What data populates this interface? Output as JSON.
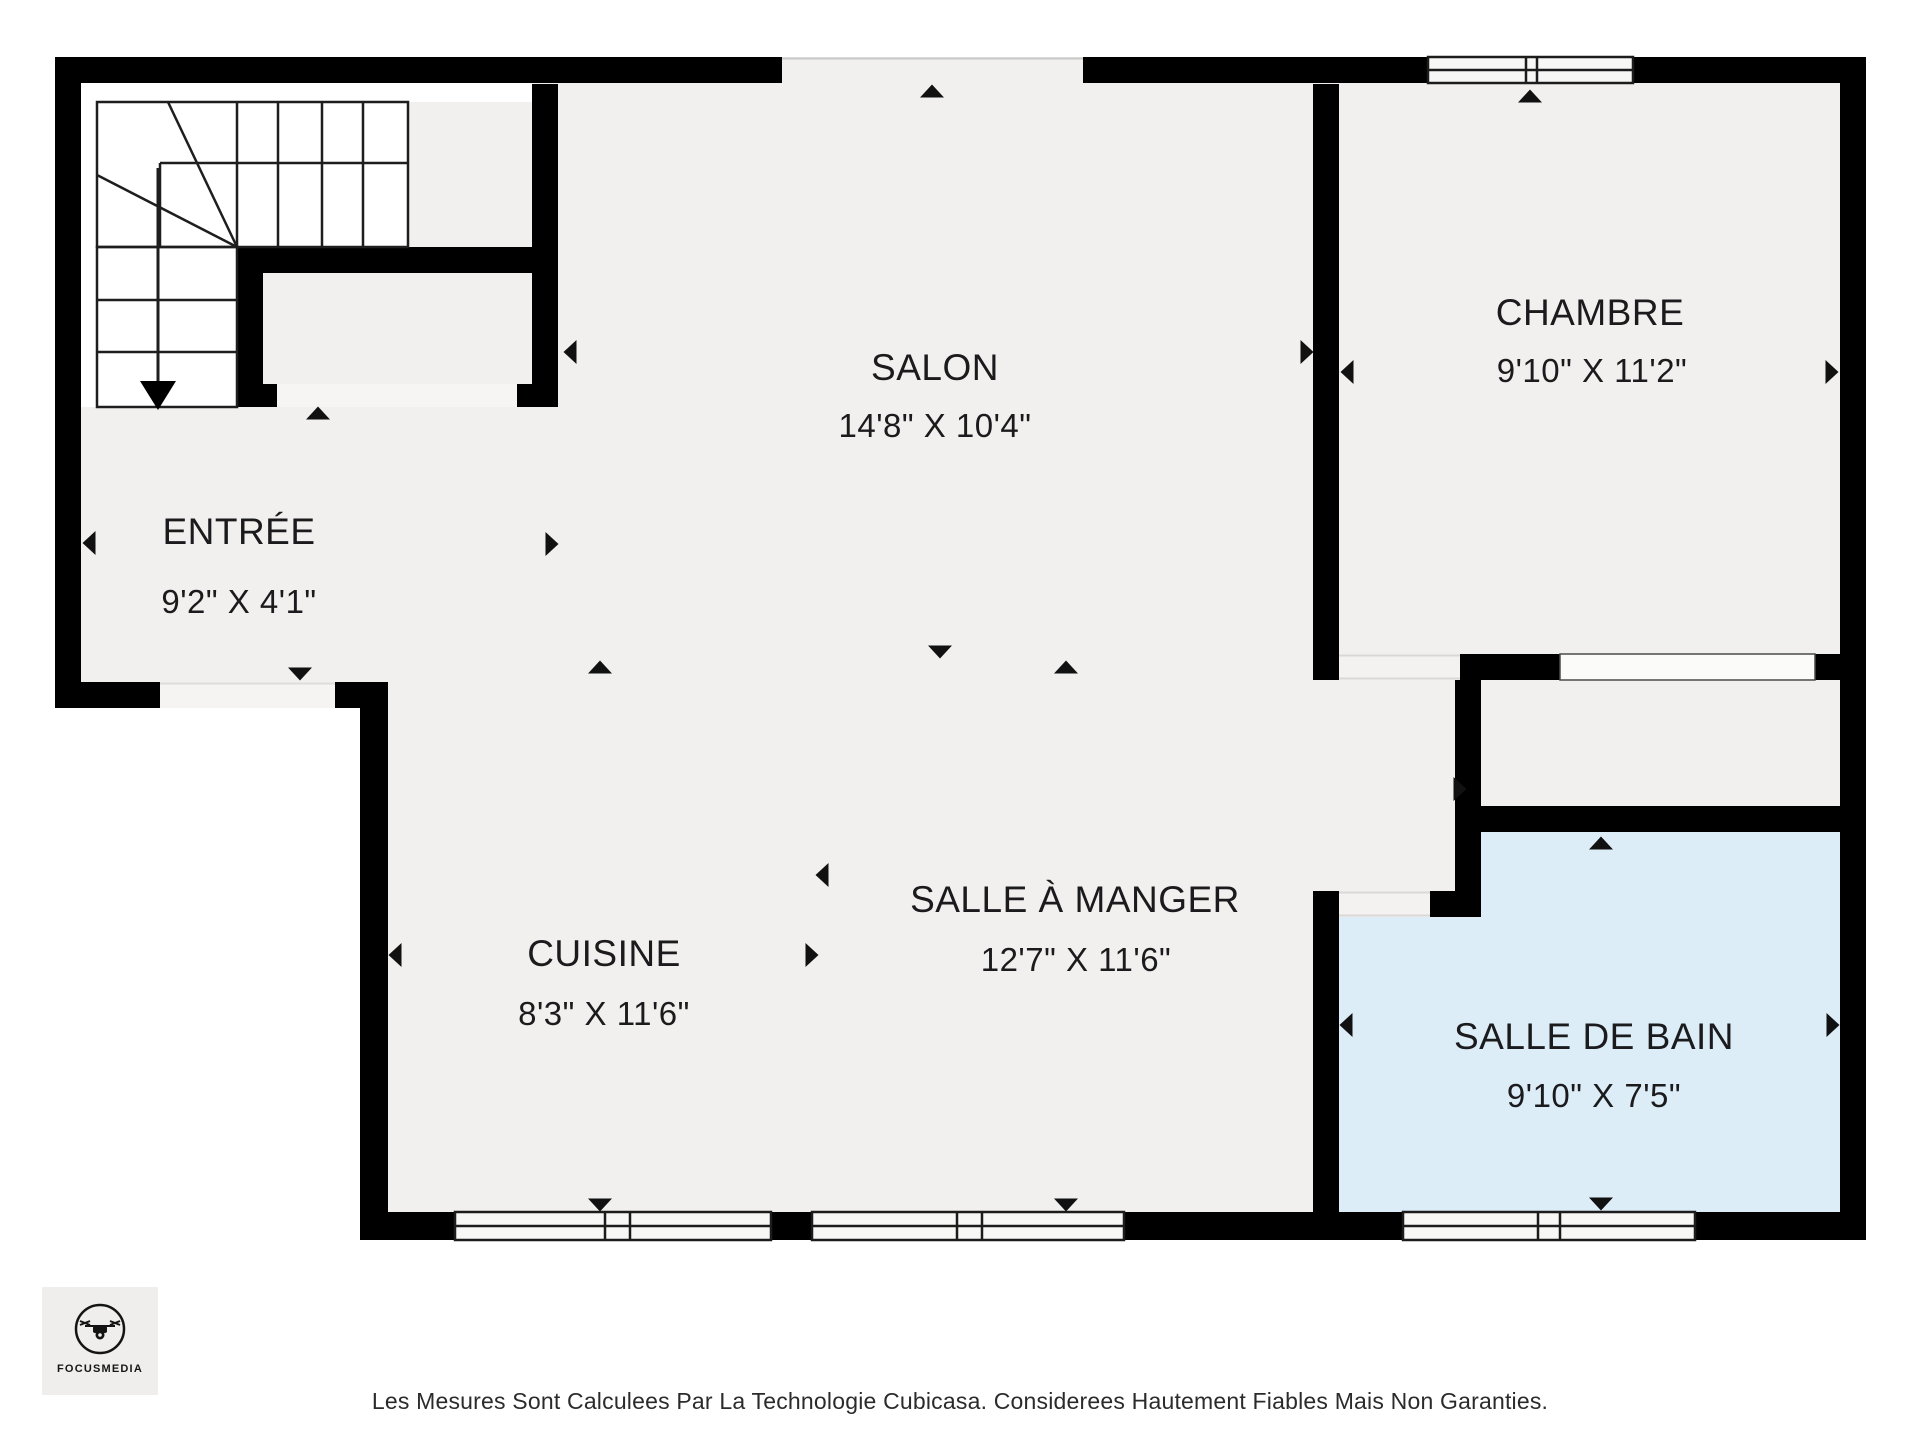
{
  "plan": {
    "type": "floorplan",
    "rooms": [
      {
        "id": "salon",
        "name": "SALON",
        "dims": "14'8\" X 10'4\""
      },
      {
        "id": "chambre",
        "name": "CHAMBRE",
        "dims": "9'10\" X 11'2\""
      },
      {
        "id": "entree",
        "name": "ENTRÉE",
        "dims": "9'2\" X 4'1\""
      },
      {
        "id": "cuisine",
        "name": "CUISINE",
        "dims": "8'3\" X 11'6\""
      },
      {
        "id": "salle_a_manger",
        "name": "SALLE À MANGER",
        "dims": "12'7\" X 11'6\""
      },
      {
        "id": "salle_de_bain",
        "name": "SALLE DE BAIN",
        "dims": "9'10\" X 7'5\""
      }
    ],
    "colors": {
      "wall": "#000000",
      "floor": "#f1f0ef",
      "bathroom_floor": "#dcedf8",
      "stair_background": "#ffffff",
      "opening": "#f5f4f3"
    }
  },
  "logo": {
    "brand": "FOCUSMEDIA"
  },
  "footer": {
    "disclaimer": "Les Mesures Sont Calculees Par La Technologie Cubicasa. Considerees Hautement Fiables Mais Non Garanties."
  }
}
